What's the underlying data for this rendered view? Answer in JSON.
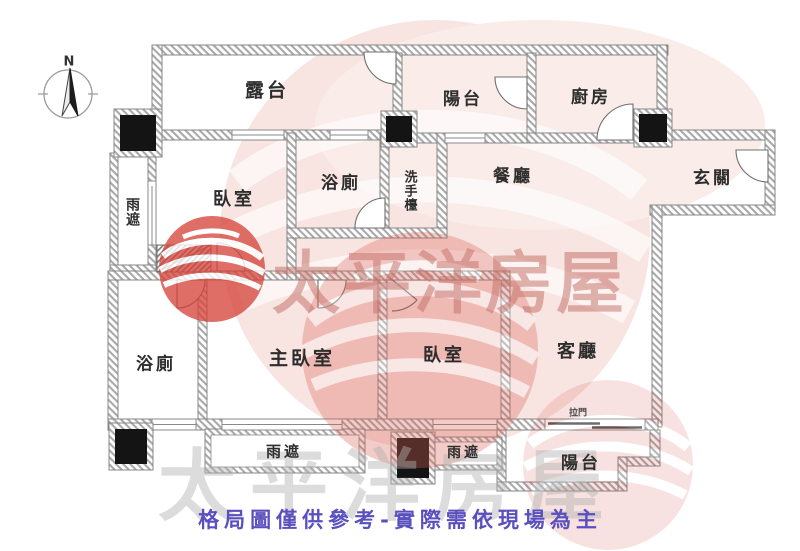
{
  "compass": {
    "north_label": "N"
  },
  "rooms": {
    "terrace": "露台",
    "balcony_top": "陽台",
    "kitchen": "廚房",
    "foyer": "玄關",
    "dining": "餐廳",
    "washbasin": "洗手檯",
    "bathroom_top": "浴廁",
    "bedroom_top": "臥室",
    "rain_cover_left": "雨遮",
    "bathroom_bottom": "浴廁",
    "master_bedroom": "主臥室",
    "bedroom_bottom": "臥室",
    "living_room": "客廳",
    "rain_cover_bottom_left": "雨遮",
    "rain_cover_bottom_right": "雨遮",
    "balcony_bottom": "陽台",
    "sliding_door": "拉門"
  },
  "watermark": {
    "brand_text": "太平洋房屋",
    "brand_text_bottom": "太平洋房屋",
    "brand_red": "#d5463c"
  },
  "footer": {
    "disclaimer": "格局圖僅供參考-實際需依現場為主",
    "color": "#5a4fbe"
  }
}
